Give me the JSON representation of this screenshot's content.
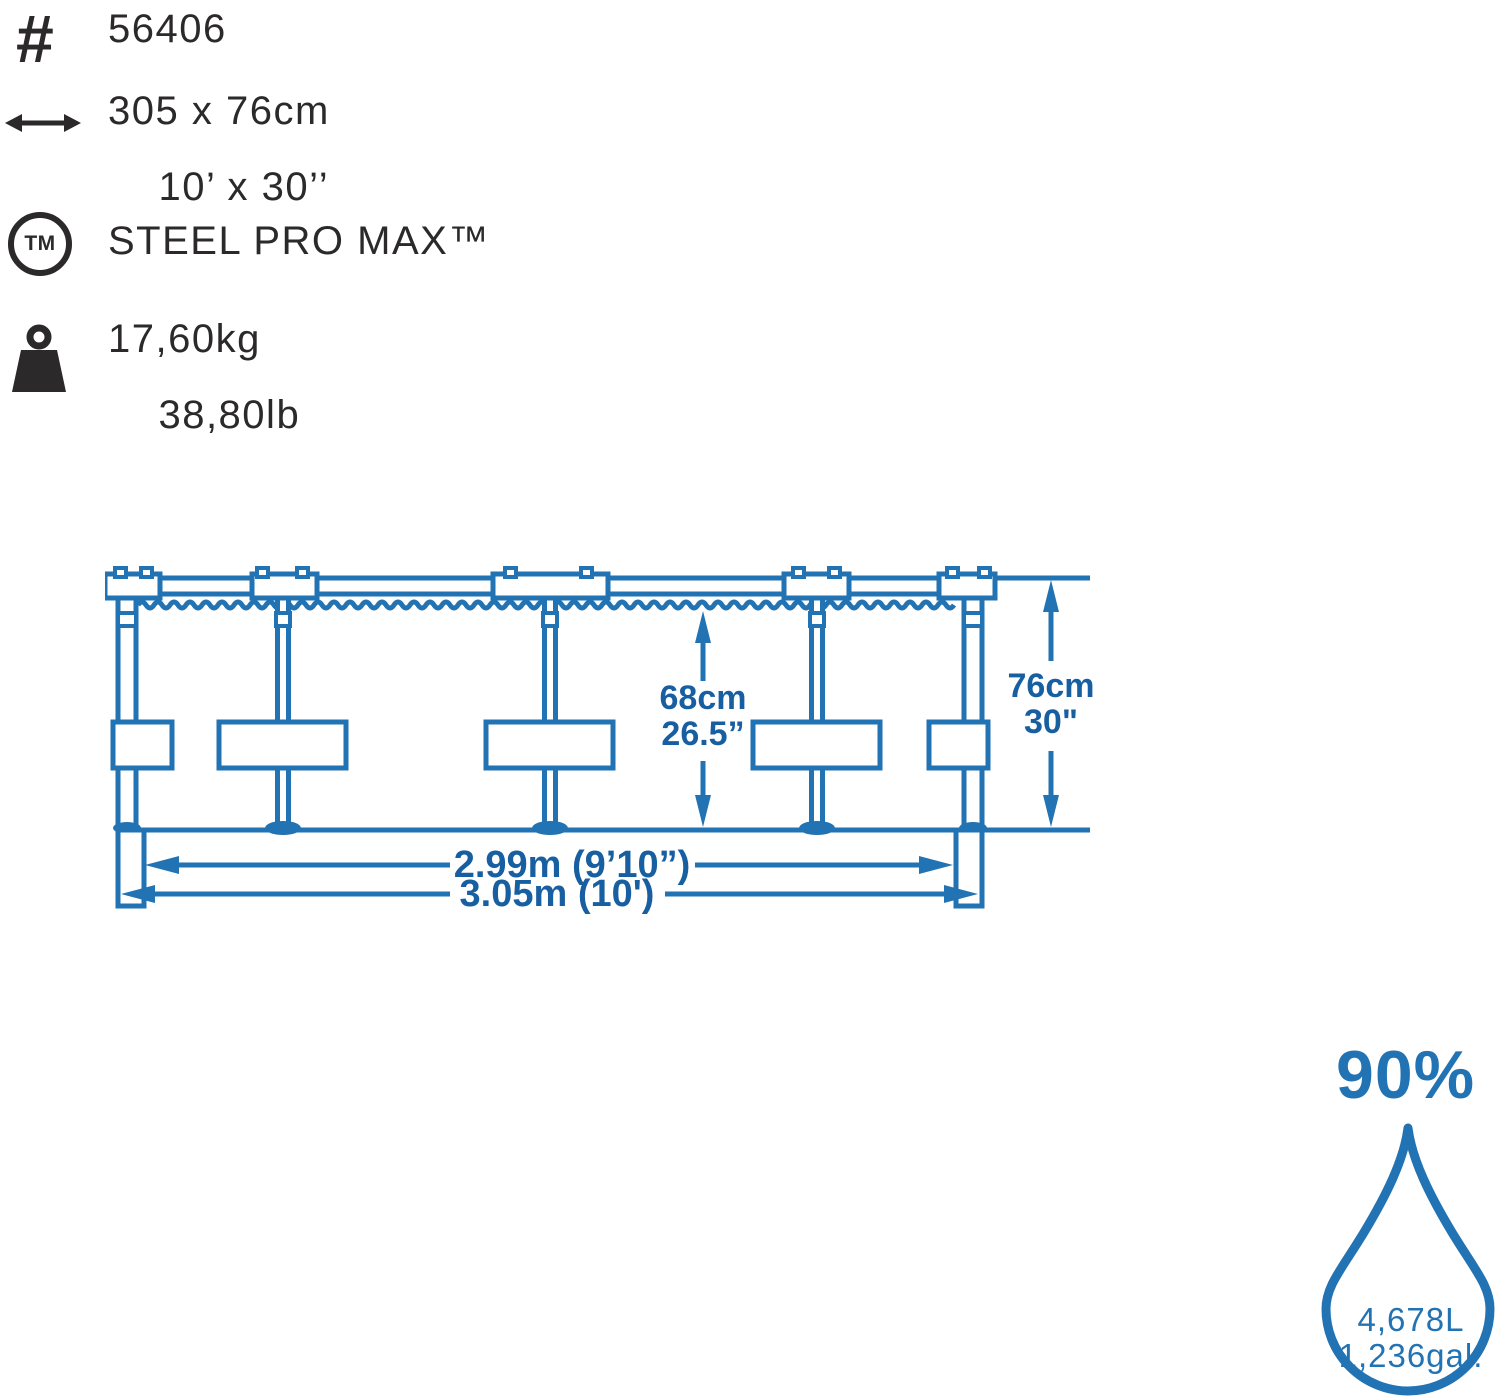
{
  "colors": {
    "ink": "#2b2929",
    "blue": "#2273b3",
    "blue_dark": "#185fa2"
  },
  "spec_list": {
    "item_number": "56406",
    "size_metric": "305 x 76cm",
    "size_imperial": "10’ x 30’’",
    "brand": "STEEL PRO MAX™",
    "tm_badge": "TM",
    "weight_metric": "17,60kg",
    "weight_imperial": "38,80lb"
  },
  "diagram": {
    "water_depth_metric": "68cm",
    "water_depth_imperial": "26.5”",
    "wall_height_metric": "76cm",
    "wall_height_imperial": "30\"",
    "inner_diameter": "2.99m (9’10”)",
    "outer_diameter": "3.05m (10')"
  },
  "capacity": {
    "fill_level": "90%",
    "volume_metric": "4,678L",
    "volume_imperial": "1,236gal."
  }
}
